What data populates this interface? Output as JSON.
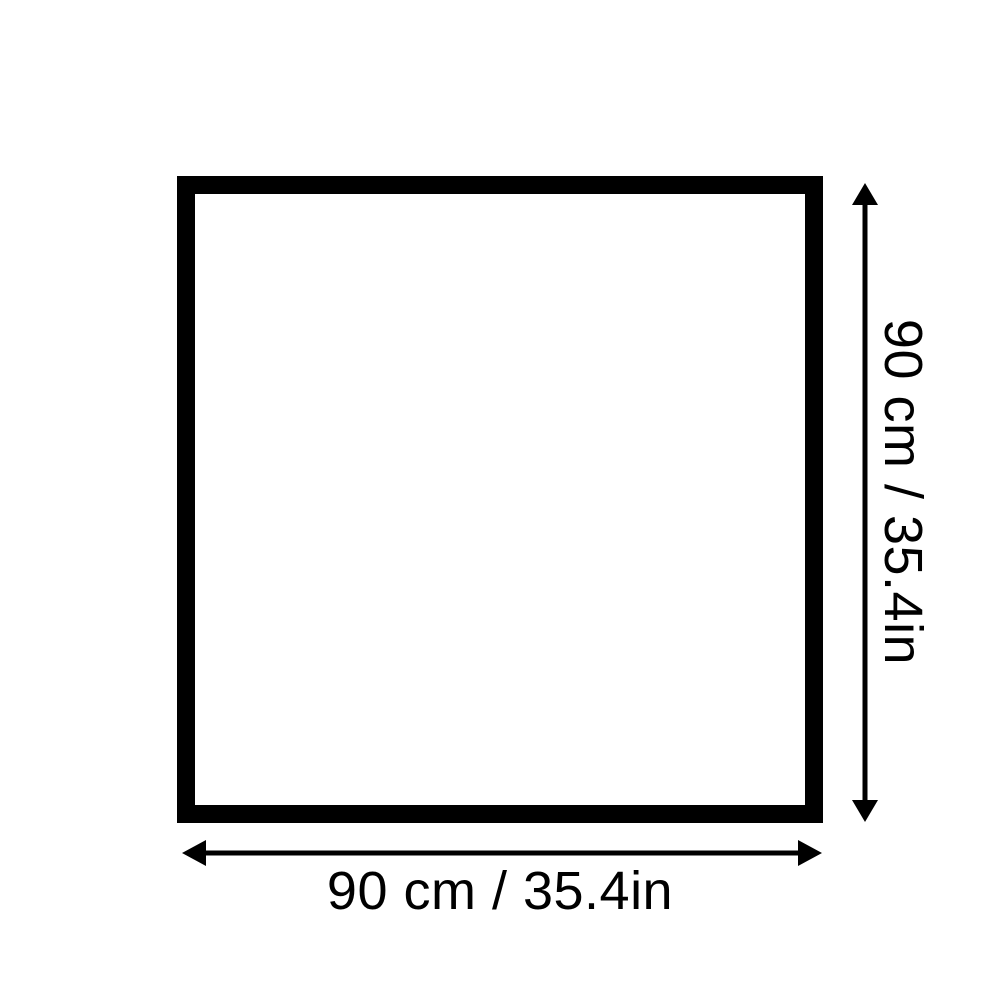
{
  "diagram": {
    "type": "product-dimension-diagram",
    "shape": "square",
    "width_label": "90 cm / 35.4in",
    "height_label": "90 cm / 35.4in",
    "width_cm": 90,
    "width_in": 35.4,
    "height_cm": 90,
    "height_in": 35.4,
    "colors": {
      "line": "#000000",
      "background": "#ffffff"
    }
  }
}
